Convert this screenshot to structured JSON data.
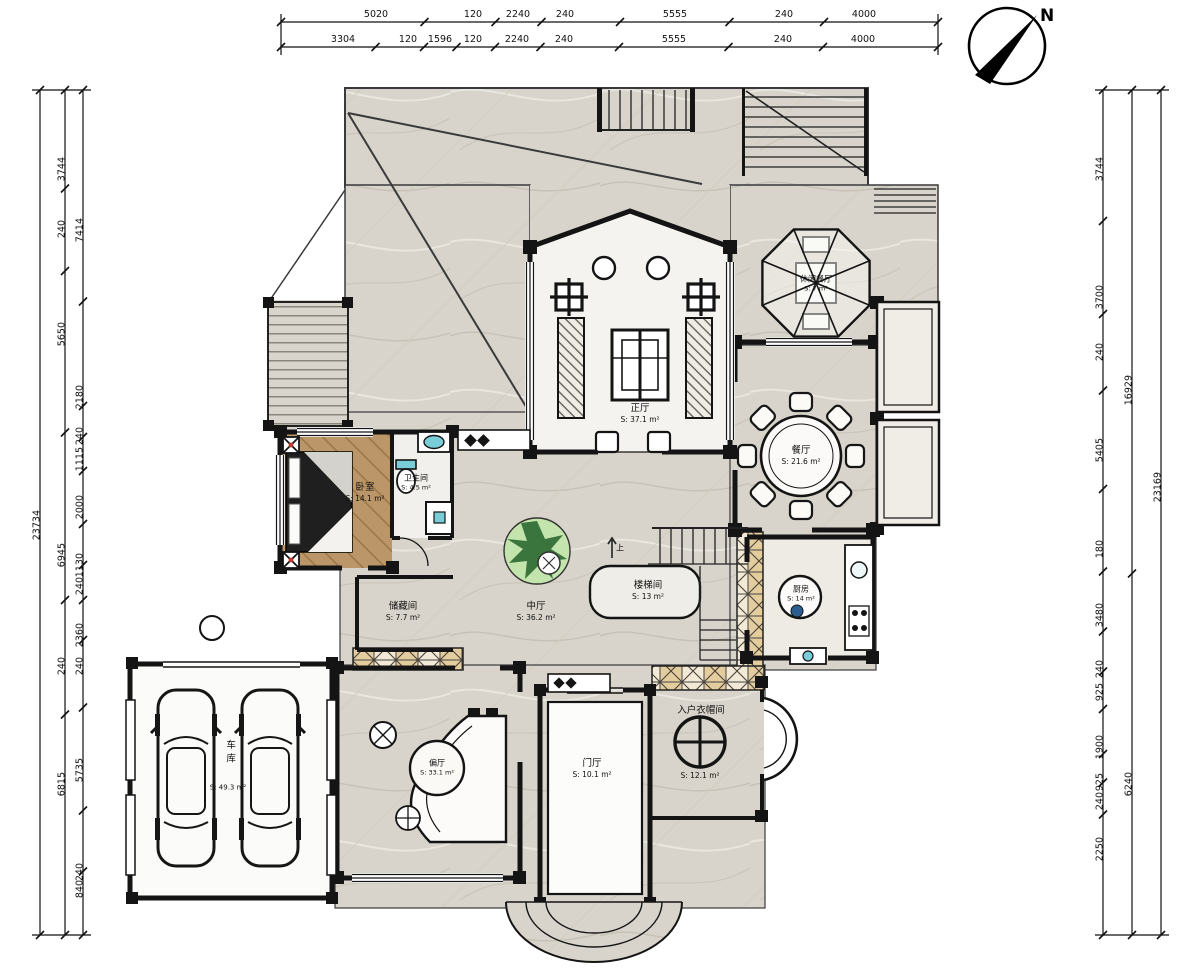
{
  "compass": {
    "north_label": "N"
  },
  "dimensions": {
    "top_row1": [
      "5020",
      "120",
      "2240",
      "240",
      "5555",
      "240",
      "4000"
    ],
    "top_row2": [
      "3304",
      "120",
      "1596",
      "120",
      "2240",
      "240",
      "5555",
      "240",
      "4000"
    ],
    "left_outer": [
      "23734"
    ],
    "left_mid": [
      "3744",
      "240",
      "5650",
      "6945",
      "240",
      "6815"
    ],
    "left_inner": [
      "7414",
      "2180",
      "240",
      "1115",
      "2000",
      "1130",
      "240",
      "2360",
      "240",
      "5735",
      "240",
      "840"
    ],
    "right_inner": [
      "3744",
      "3700",
      "240",
      "5405",
      "180",
      "3480",
      "240",
      "925",
      "1900",
      "925",
      "240",
      "2250"
    ],
    "right_mid": [
      "16929",
      "6240"
    ],
    "right_outer": [
      "23169"
    ]
  },
  "rooms": [
    {
      "name": "正厅",
      "area": "S: 37.1 m²"
    },
    {
      "name": "餐厅",
      "area": "S: 21.6 m²"
    },
    {
      "name": "卧室",
      "area": "S: 14.1 m²"
    },
    {
      "name": "卫生间",
      "area": "S: 4.5 m²"
    },
    {
      "name": "中厅",
      "area": "S: 36.2 m²"
    },
    {
      "name": "楼梯间",
      "area": "S: 13 m²"
    },
    {
      "name": "厨房",
      "area": "S: 14 m²"
    },
    {
      "name": "储藏间",
      "area": "S: 7.7 m²"
    },
    {
      "name": "车库",
      "area": "S: 49.3 m²"
    },
    {
      "name": "偏厅",
      "area": "S: 33.1 m²"
    },
    {
      "name": "门厅",
      "area": "S: 10.1 m²"
    },
    {
      "name": "入户衣帽间",
      "area": "S: 12.1 m²"
    },
    {
      "name": "休闲餐厅",
      "area": "S: 7 m²"
    }
  ],
  "stair": {
    "up_label": "上"
  },
  "colors": {
    "wall": "#141414",
    "marble_floor": "#d8d4cb",
    "wood_floor": "#bb9668",
    "accent_cyan": "#79cdd8",
    "accent_green": "#2e6b33",
    "accent_red": "#c0392b",
    "checker_tan": "#e3cd9e"
  }
}
